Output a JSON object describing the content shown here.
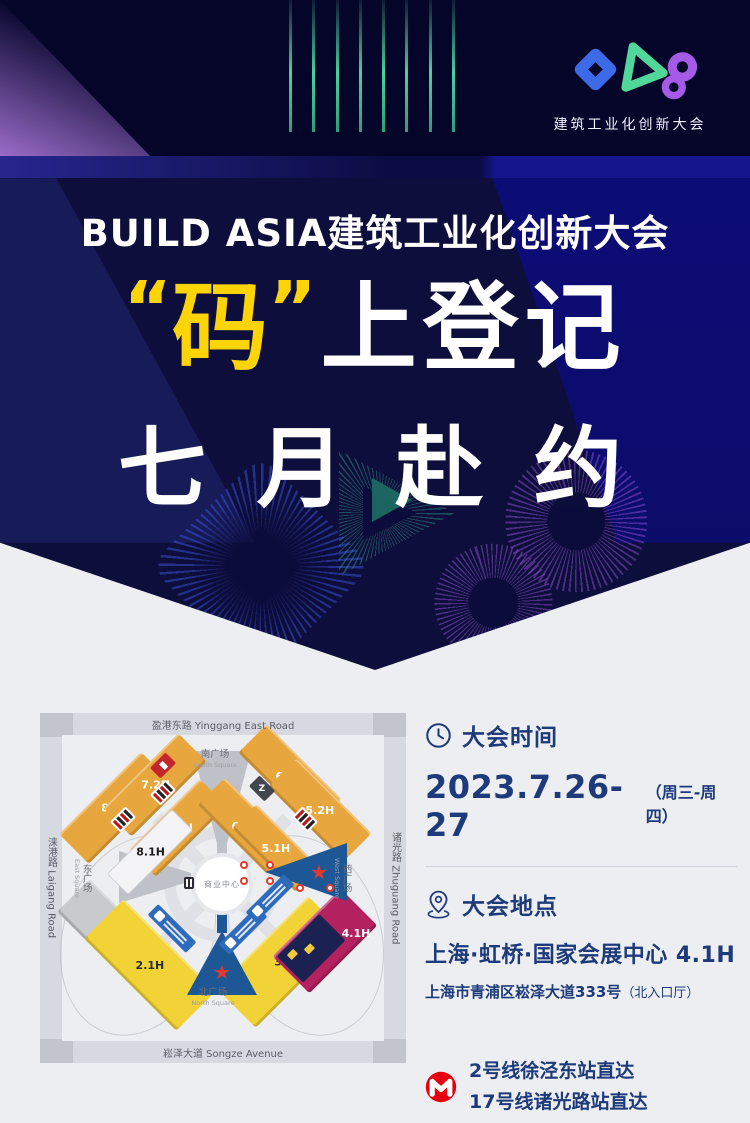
{
  "brand": {
    "logo_caption": "建筑工业化创新大会",
    "logo_colors": {
      "blue": "#3d6be8",
      "green": "#52d79b",
      "purple": "#a55ae8"
    }
  },
  "hero": {
    "title": "BUILD ASIA建筑工业化创新大会",
    "quote_open": "“",
    "highlight": "码",
    "quote_close": "”",
    "line1_rest": "上登记",
    "line2": "七 月 赴 约",
    "highlight_color": "#fdd408"
  },
  "map": {
    "roads": {
      "top": "盈港东路 Yinggang East Road",
      "bottom": "崧泽大道 Songze Avenue",
      "left": "涞港路 Laigang Road",
      "right": "诸光路 Zhuguang Road"
    },
    "squares": {
      "south_cn": "南广场",
      "south_en": "South Square",
      "north_cn": "北广场",
      "north_en": "North Square",
      "east_cn": "东广场",
      "east_en": "East Square",
      "west_cn": "西广场",
      "west_en": "West Square"
    },
    "center_label": "商业中心",
    "halls": {
      "h82": "8.2H",
      "h72": "7.2H",
      "h71": "7.1H",
      "h81": "8.1H",
      "h62": "6.2H",
      "h52": "5.2H",
      "h61": "6.1H",
      "h51": "5.1H",
      "h11": "1.1H",
      "h21": "2.1H",
      "h3": "3H",
      "h41": "4.1H"
    },
    "badges": {
      "z": "Z"
    },
    "hall_colors": {
      "orange": "#e8a73e",
      "yellow": "#f2d337",
      "gray": "#c9cacd",
      "white": "#f4f4f6",
      "magenta": "#b3215f",
      "entrance_blue": "#1d5796"
    }
  },
  "info": {
    "accent_color": "#1d3a7a",
    "time": {
      "heading": "大会时间",
      "date": "2023.7.26-27",
      "days": "（周三-周四）"
    },
    "location": {
      "heading": "大会地点",
      "venue": "上海·虹桥·国家会展中心 4.1H",
      "address": "上海市青浦区崧泽大道333号",
      "note": "（北入口厅）"
    },
    "metro": {
      "line1": "2号线徐泾东站直达",
      "line2": "17号线诸光路站直达",
      "brand_red": "#e60012"
    }
  }
}
